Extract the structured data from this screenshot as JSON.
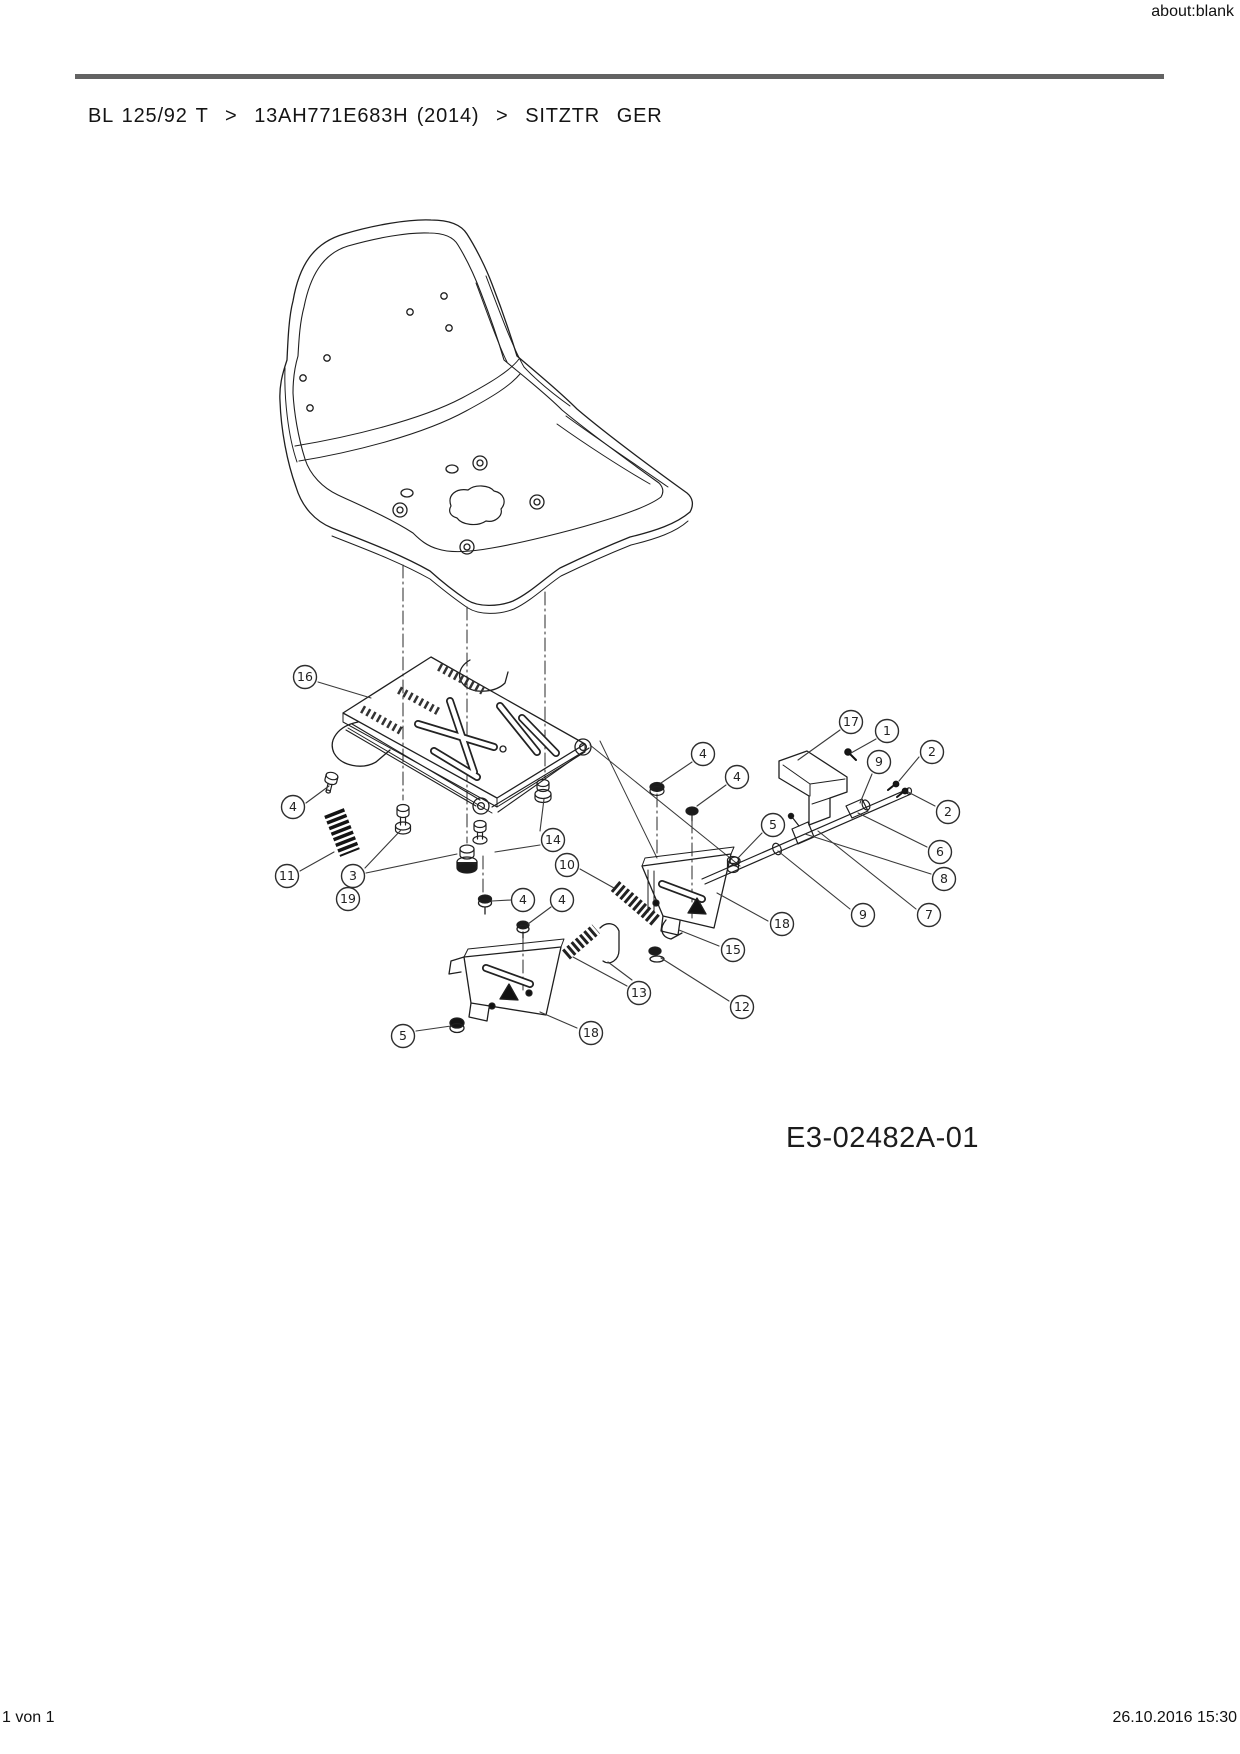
{
  "page": {
    "url_label": "about:blank"
  },
  "breadcrumb": {
    "path": "BL 125/92 T  >  13AH771E683H (2014)  >  SITZTR  GER"
  },
  "diagram": {
    "code": "E3-02482A-01",
    "colors": {
      "line": "#1f1f1f",
      "rule": "#636363"
    },
    "callouts": [
      {
        "n": "16",
        "cx": 305,
        "cy": 677,
        "l": [
          [
            318,
            682,
            371,
            698
          ]
        ]
      },
      {
        "n": "4",
        "cx": 293,
        "cy": 807,
        "l": [
          [
            306,
            803,
            329,
            786
          ]
        ]
      },
      {
        "n": "11",
        "cx": 287,
        "cy": 876,
        "l": [
          [
            300,
            871,
            334,
            852
          ]
        ]
      },
      {
        "n": "3",
        "cx": 353,
        "cy": 876,
        "l": [
          [
            365,
            868,
            401,
            830
          ],
          [
            366,
            873,
            457,
            854
          ]
        ]
      },
      {
        "n": "19",
        "cx": 348,
        "cy": 899,
        "l": []
      },
      {
        "n": "14",
        "cx": 553,
        "cy": 840,
        "l": [
          [
            540,
            831,
            544,
            799
          ],
          [
            540,
            845,
            495,
            852
          ]
        ]
      },
      {
        "n": "10",
        "cx": 567,
        "cy": 865,
        "l": [
          [
            580,
            869,
            614,
            888
          ]
        ]
      },
      {
        "n": "4",
        "cx": 523,
        "cy": 900,
        "l": [
          [
            511,
            900,
            492,
            901
          ]
        ]
      },
      {
        "n": "4",
        "cx": 562,
        "cy": 900,
        "l": [
          [
            551,
            907,
            528,
            924
          ]
        ]
      },
      {
        "n": "17",
        "cx": 851,
        "cy": 722,
        "l": [
          [
            840,
            730,
            798,
            760
          ]
        ]
      },
      {
        "n": "1",
        "cx": 887,
        "cy": 731,
        "l": [
          [
            876,
            739,
            851,
            753
          ]
        ]
      },
      {
        "n": "2",
        "cx": 932,
        "cy": 752,
        "l": [
          [
            919,
            757,
            899,
            781
          ]
        ]
      },
      {
        "n": "9",
        "cx": 879,
        "cy": 762,
        "l": [
          [
            872,
            774,
            860,
            803
          ]
        ]
      },
      {
        "n": "2",
        "cx": 948,
        "cy": 812,
        "l": [
          [
            935,
            806,
            908,
            792
          ]
        ]
      },
      {
        "n": "6",
        "cx": 940,
        "cy": 852,
        "l": [
          [
            927,
            847,
            858,
            813
          ]
        ]
      },
      {
        "n": "8",
        "cx": 944,
        "cy": 879,
        "l": [
          [
            931,
            874,
            805,
            834
          ]
        ]
      },
      {
        "n": "9",
        "cx": 863,
        "cy": 915,
        "l": [
          [
            850,
            909,
            778,
            851
          ]
        ]
      },
      {
        "n": "7",
        "cx": 929,
        "cy": 915,
        "l": [
          [
            916,
            909,
            818,
            831
          ]
        ]
      },
      {
        "n": "18",
        "cx": 782,
        "cy": 924,
        "l": [
          [
            768,
            921,
            717,
            893
          ]
        ]
      },
      {
        "n": "15",
        "cx": 733,
        "cy": 950,
        "l": [
          [
            719,
            946,
            679,
            930
          ]
        ]
      },
      {
        "n": "13",
        "cx": 639,
        "cy": 993,
        "l": [
          [
            627,
            986,
            573,
            957
          ],
          [
            632,
            980,
            608,
            962
          ]
        ]
      },
      {
        "n": "12",
        "cx": 742,
        "cy": 1007,
        "l": [
          [
            729,
            1001,
            661,
            958
          ]
        ]
      },
      {
        "n": "18",
        "cx": 591,
        "cy": 1033,
        "l": [
          [
            577,
            1028,
            540,
            1012
          ]
        ]
      },
      {
        "n": "5",
        "cx": 403,
        "cy": 1036,
        "l": [
          [
            416,
            1031,
            451,
            1026
          ]
        ]
      },
      {
        "n": "5",
        "cx": 773,
        "cy": 825,
        "l": [
          [
            762,
            833,
            738,
            858
          ]
        ]
      },
      {
        "n": "4",
        "cx": 703,
        "cy": 754,
        "l": [
          [
            692,
            762,
            661,
            783
          ]
        ]
      },
      {
        "n": "4",
        "cx": 737,
        "cy": 777,
        "l": [
          [
            726,
            785,
            697,
            806
          ]
        ]
      }
    ]
  },
  "footer": {
    "page_indicator": "1 von 1",
    "printed_at": "26.10.2016 15:30"
  }
}
